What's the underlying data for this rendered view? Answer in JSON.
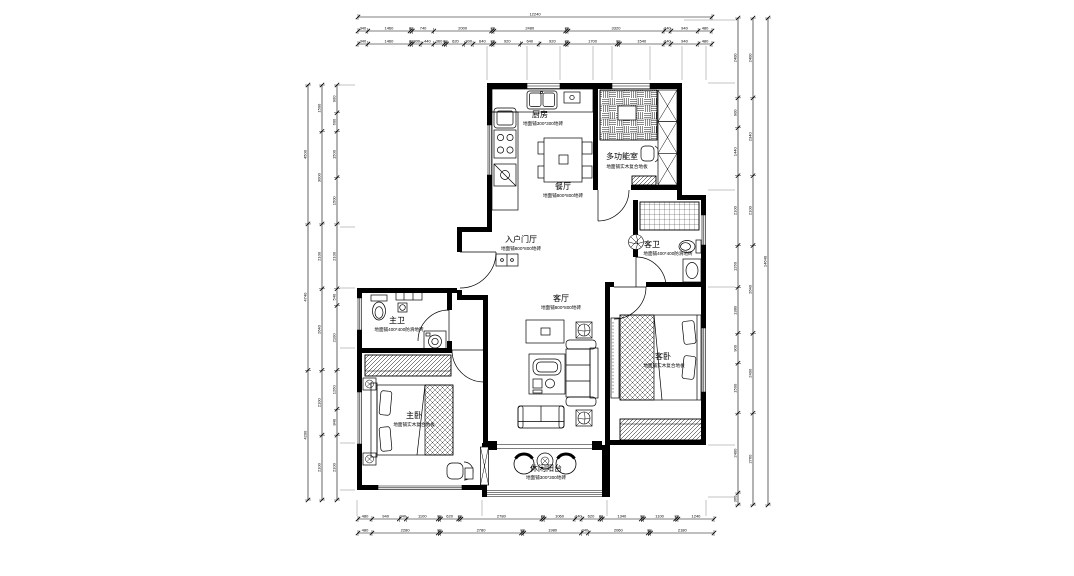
{
  "drawing": {
    "type": "floor-plan",
    "line_color": "#000000",
    "background": "#ffffff"
  },
  "rooms": {
    "kitchen": {
      "name": "厨房",
      "note": "地面铺300*300地砖"
    },
    "multi": {
      "name": "多功能室",
      "note": "地面铺实木复合地板"
    },
    "dining": {
      "name": "餐厅",
      "note": "地面铺800*800地砖"
    },
    "entry": {
      "name": "入户门厅",
      "note": "地面铺800*800地砖"
    },
    "guest_bath": {
      "name": "客卫",
      "note": "地面铺400*400防滑地砖"
    },
    "master_bath": {
      "name": "主卫",
      "note": "地面铺400*400防滑地砖"
    },
    "living": {
      "name": "客厅",
      "note": "地面铺800*800地砖"
    },
    "guest_bed": {
      "name": "客卧",
      "note": "地面铺实木复合地板"
    },
    "master_bed": {
      "name": "主卧",
      "note": "地面铺实木复合地板"
    },
    "balcony": {
      "name": "休闲阳台",
      "note": "地面铺300*300地砖"
    }
  },
  "dimensions": {
    "top": [
      {
        "orient": "h",
        "x0": 358,
        "x1": 712,
        "y": 17,
        "segs": [
          12240
        ]
      },
      {
        "orient": "h",
        "x0": 358,
        "x1": 712,
        "y": 31,
        "segs": [
          340,
          1460,
          80,
          740,
          2000,
          80,
          2480,
          80,
          3320,
          240,
          940,
          480
        ]
      },
      {
        "orient": "h",
        "x0": 358,
        "x1": 712,
        "y": 44,
        "segs": [
          340,
          1460,
          80,
          300,
          440,
          360,
          80,
          620,
          300,
          640,
          80,
          920,
          640,
          920,
          80,
          1700,
          80,
          1540,
          240,
          940,
          480
        ]
      }
    ],
    "bottom": [
      {
        "orient": "h",
        "x0": 358,
        "x1": 714,
        "y": 519,
        "segs": [
          480,
          940,
          240,
          1100,
          80,
          620,
          80,
          2780,
          80,
          1060,
          240,
          620,
          80,
          1340,
          80,
          1100,
          80,
          1240
        ]
      },
      {
        "orient": "h",
        "x0": 358,
        "x1": 714,
        "y": 533,
        "segs": [
          480,
          2280,
          80,
          2780,
          80,
          1980,
          240,
          2060,
          80,
          2180
        ]
      }
    ],
    "left": [
      {
        "orient": "v",
        "x": 308,
        "y0": 85,
        "y1": 500,
        "segs": [
          4500,
          4740,
          4200
        ]
      },
      {
        "orient": "v",
        "x": 322,
        "y0": 85,
        "y1": 500,
        "segs": [
          1500,
          3000,
          2100,
          2640,
          2100,
          2100
        ]
      },
      {
        "orient": "v",
        "x": 337,
        "y0": 85,
        "y1": 500,
        "segs": [
          900,
          600,
          1500,
          1500,
          2100,
          540,
          2100,
          1260,
          840,
          2100
        ]
      }
    ],
    "right": [
      {
        "orient": "v",
        "x": 738,
        "y0": 18,
        "y1": 505,
        "segs": [
          2400,
          900,
          1440,
          2100,
          1260,
          1380,
          900,
          1500,
          2400,
          360
        ]
      },
      {
        "orient": "v",
        "x": 753,
        "y0": 18,
        "y1": 505,
        "segs": [
          2400,
          2340,
          2100,
          2640,
          2400,
          2760
        ]
      },
      {
        "orient": "v",
        "x": 768,
        "y0": 18,
        "y1": 505,
        "segs": [
          14640
        ]
      }
    ]
  }
}
